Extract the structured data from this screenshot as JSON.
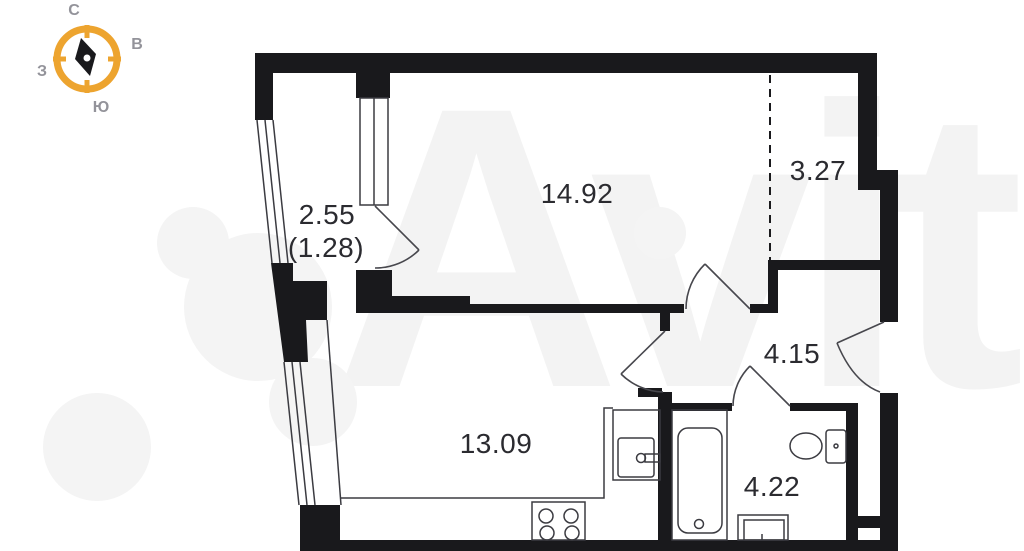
{
  "plan": {
    "rooms": {
      "balcony": {
        "area": "2.55",
        "area_reduced": "(1.28)"
      },
      "living_room": {
        "area": "14.92"
      },
      "niche": {
        "area": "3.27"
      },
      "hallway": {
        "area": "4.15"
      },
      "kitchen": {
        "area": "13.09"
      },
      "bathroom": {
        "area": "4.22"
      }
    }
  },
  "compass": {
    "north": "С",
    "east": "В",
    "south": "Ю",
    "west": "З"
  },
  "watermark": {
    "brand": "Avito"
  },
  "colors": {
    "wall": "#19191c",
    "thin_line": "#3b3b41",
    "door_line": "#47474d",
    "compass_ring": "#EDA42F",
    "compass_needle": "#19191c",
    "compass_label": "#93939a",
    "area_label": "#2b2b30",
    "watermark": "#f3f3f3",
    "background": "#ffffff"
  }
}
